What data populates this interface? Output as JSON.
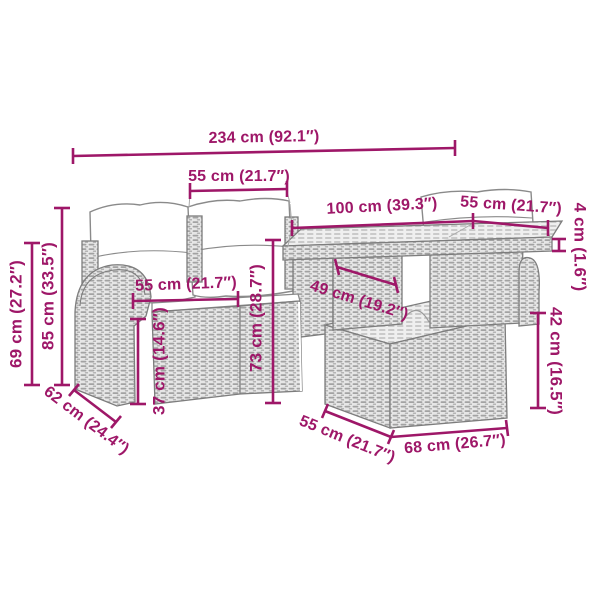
{
  "diagram": {
    "description": "Poly rattan garden lounge set with cushions and table — dimension diagram",
    "accent_color": "#9E1768",
    "furniture_outline_color": "#7d7d7d",
    "dims": {
      "total_width": "234 cm (92.1″)",
      "back_cushion_width": "55 cm (21.7″)",
      "table_length": "100 cm (39.3″)",
      "table_side": "55 cm (21.7″)",
      "tabletop_thickness": "4 cm (1.6″)",
      "armrest_height": "69 cm (27.2″)",
      "back_height": "85 cm (33.5″)",
      "seat_width": "55 cm (21.7″)",
      "seat_height": "37 cm (14.6″)",
      "right_section_height": "73 cm (28.7″)",
      "under_table_clearance": "49 cm (19.2″)",
      "ottoman_height": "42 cm (16.5″)",
      "seat_depth": "62 cm (24.4″)",
      "ottoman_depth": "55 cm (21.7″)",
      "ottoman_width": "68 cm (26.7″)"
    }
  }
}
